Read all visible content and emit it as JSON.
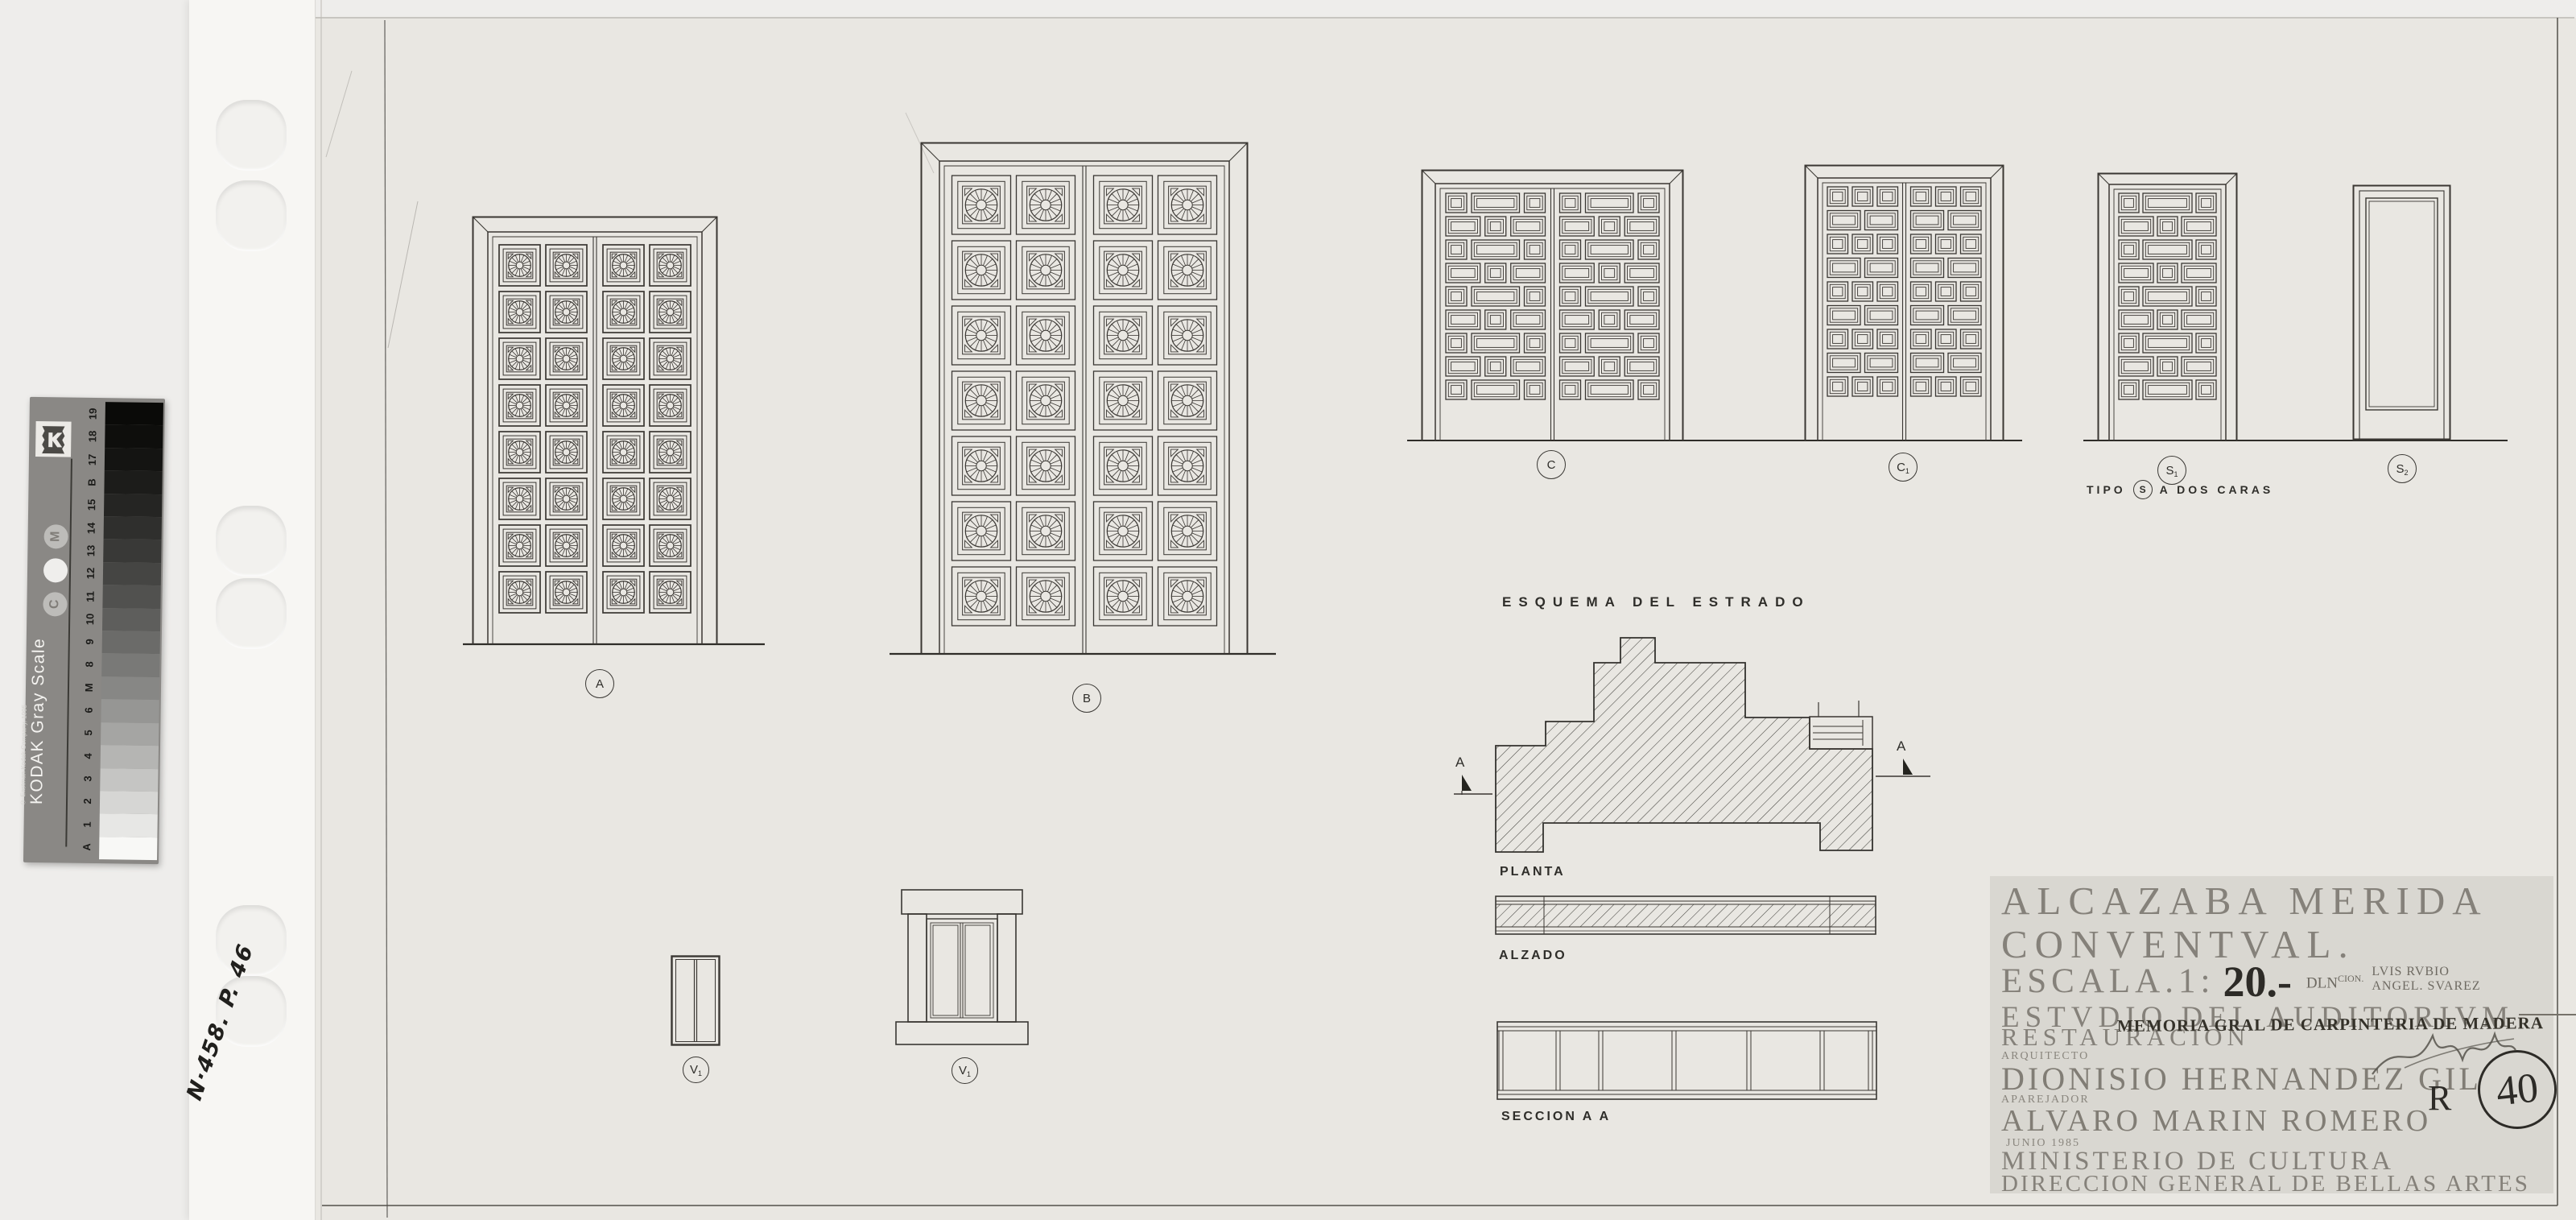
{
  "scan": {
    "handwritten_ref": "N·458. P. 46",
    "gray_scale": {
      "title": "KODAK Gray Scale",
      "copyright": "© Eastman Kodak Company, 1995",
      "logo_text": "Kodak",
      "dot_letters": [
        "M",
        "",
        "C"
      ],
      "ticks_bottom_to_top": [
        "A",
        "1",
        "2",
        "3",
        "4",
        "5",
        "6",
        "M",
        "8",
        "9",
        "10",
        "11",
        "12",
        "13",
        "14",
        "15",
        "B",
        "17",
        "18",
        "19"
      ]
    }
  },
  "drawings": {
    "doors": [
      {
        "id": "A",
        "label": {
          "main": "A",
          "sub": ""
        },
        "style": "rosette",
        "leaves": 2,
        "rows": 8
      },
      {
        "id": "B",
        "label": {
          "main": "B",
          "sub": ""
        },
        "style": "rosette",
        "leaves": 2,
        "rows": 7
      },
      {
        "id": "C",
        "label": {
          "main": "C",
          "sub": ""
        },
        "style": "geoC",
        "leaves": 2,
        "rows": 9
      },
      {
        "id": "C1",
        "label": {
          "main": "C",
          "sub": "1"
        },
        "style": "geoC1",
        "leaves": 2,
        "rows": 9
      },
      {
        "id": "S1",
        "label": {
          "main": "S",
          "sub": "1"
        },
        "style": "geoC",
        "leaves": 1,
        "rows": 9
      },
      {
        "id": "S2",
        "label": {
          "main": "S",
          "sub": "2"
        },
        "style": "plain",
        "leaves": 1,
        "rows": 0
      }
    ],
    "windows": [
      {
        "id": "V1p",
        "label": {
          "main": "V",
          "sub": "1"
        }
      },
      {
        "id": "V1",
        "label": {
          "main": "V",
          "sub": "1"
        }
      }
    ],
    "type_note": {
      "prefix": "TIPO",
      "circled": "S",
      "suffix": "A DOS CARAS"
    },
    "esquema": {
      "title": "ESQUEMA DEL ESTRADO",
      "plan_label": "PLANTA",
      "elevation_label": "ALZADO",
      "section_label": "SECCION A A",
      "section_marker": "A"
    }
  },
  "title_block": {
    "project_line1": "ALCAZABA MERIDA",
    "project_line2": "CONVENTVAL.",
    "scale_label": "ESCALA.1:",
    "scale_value": "20.-",
    "draftsman_label": "DLN",
    "draftsman_label_sup": "CION.",
    "draftsmen": [
      "LVIS RVBIO",
      "ANGEL. SVAREZ"
    ],
    "study_line": "ESTVDIO DEL AUDITORIVM",
    "restoration": "RESTAURACION",
    "memoria_stamp": "MEMORIA GRAL DE CARPINTERIA DE MADERA",
    "architect_label": "ARQUITECTO",
    "architect": "DIONISIO HERNANDEZ GIL",
    "surveyor_label": "APAREJADOR",
    "surveyor": "ALVARO MARIN ROMERO",
    "date": "JUNIO 1985",
    "ministry": "MINISTERIO DE CULTURA",
    "direction": "DIRECCION GENERAL DE BELLAS ARTES",
    "revision_letter": "R",
    "sheet_number": "40"
  }
}
